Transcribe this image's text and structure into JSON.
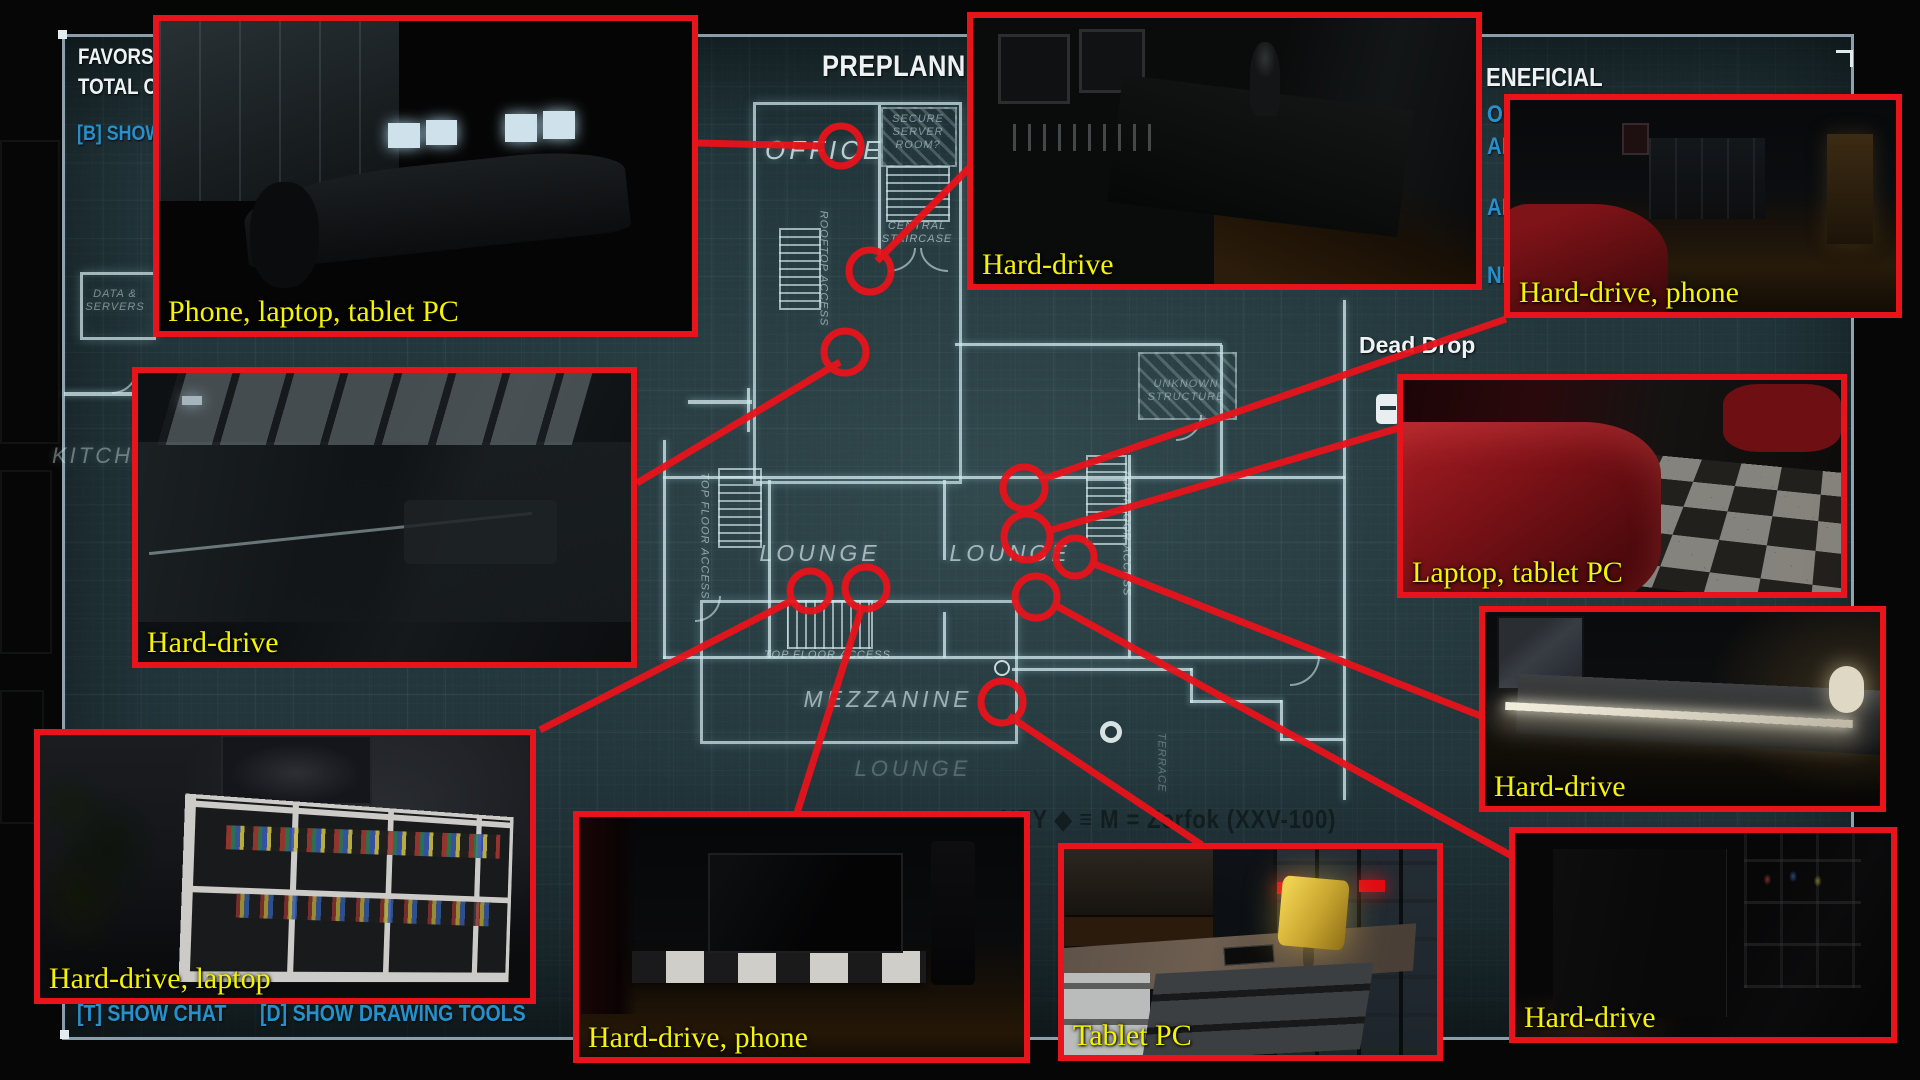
{
  "hud": {
    "favors": "FAVORS",
    "total_cost": "TOTAL C",
    "show_assets": "[B] SHOW",
    "title": "PREPLANNIN",
    "beneficial": "ENEFICIAL",
    "frag_op": "OP",
    "frag_an": "AN",
    "frag_al": "AL",
    "frag_ni": "NII",
    "show_chat": "[T] SHOW CHAT",
    "show_drawing": "[D] SHOW DRAWING TOOLS",
    "money_line": "NEY    ◆ ≡ M  =  Zerfok (XXV-100)"
  },
  "map": {
    "dead_drop": "Dead Drop",
    "office": "OFFICE",
    "secure_server": [
      "SECURE",
      "SERVER",
      "ROOM?"
    ],
    "central_staircase": [
      "CENTRAL",
      "STAIRCASE"
    ],
    "rooftop_access": "ROOFTOP ACCESS",
    "top_floor_access": "TOP FLOOR ACCESS",
    "lounge": "LOUNGE",
    "mezzanine": "MEZZANINE",
    "terrace": "TERRACE",
    "unknown_structure": [
      "UNKNOWN",
      "STRUCTURE"
    ],
    "kitchen": "KITCHEN",
    "data_servers": [
      "DATA &",
      "SERVERS"
    ]
  },
  "callouts": {
    "office_desk": {
      "label": "Phone, laptop, tablet PC"
    },
    "server_shelf": {
      "label": "Hard-drive"
    },
    "lounge_couch": {
      "label": "Hard-drive, phone"
    },
    "loft_bedroom": {
      "label": "Hard-drive"
    },
    "red_sofa": {
      "label": "Laptop, tablet PC"
    },
    "bookshelf": {
      "label": "Hard-drive, laptop"
    },
    "tv_room": {
      "label": "Hard-drive, phone"
    },
    "dresser_lamp": {
      "label": "Tablet PC"
    },
    "sideboard": {
      "label": "Hard-drive"
    },
    "dark_shelves": {
      "label": "Hard-drive"
    }
  },
  "colors": {
    "accent_red": "#e8131b",
    "label_yellow": "#f6f200",
    "hud_blue": "#2591cc",
    "blueprint_line": "#cfe3e6"
  }
}
